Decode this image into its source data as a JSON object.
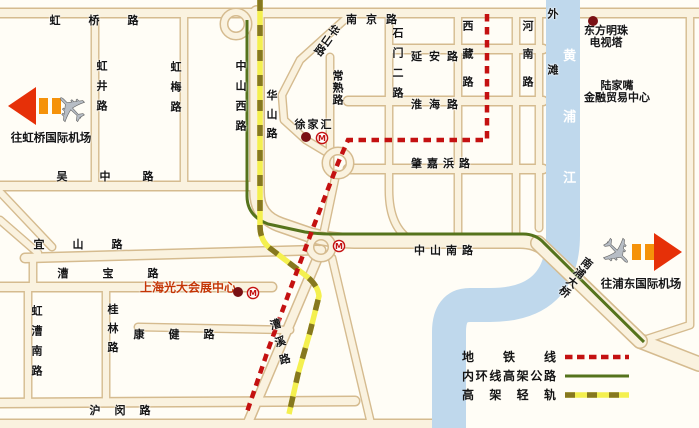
{
  "colors": {
    "metro_line": "#c41111",
    "inner_ring_line": "#55731c",
    "light_rail": "#f4f04f",
    "light_rail_dash": "#86781f",
    "river": "#bfd8ec",
    "road_fill": "#faf2df",
    "road_edge": "#d5bb8f",
    "label_text": "#151515",
    "red_label_text": "#c43605",
    "arrow_red": "#e63008",
    "arrow_orange": "#f5920a",
    "plane_gray": "#b7bdc5",
    "landmark_dot": "#7a1014",
    "river_label": "#ffffff"
  },
  "legend": {
    "items": [
      {
        "label": "地铁线",
        "type": "metro-line"
      },
      {
        "label": "内环线高架公路",
        "type": "inner-ring-elevated-road"
      },
      {
        "label": "高架轻轨",
        "type": "elevated-light-rail"
      }
    ]
  },
  "labels": [
    {
      "name": "road-label-hongqiao-rd",
      "text": "虹桥路",
      "x": 108,
      "y": 21,
      "v": 0,
      "sp": 28
    },
    {
      "name": "road-label-nanjing-rd",
      "text": "南京路",
      "x": 376,
      "y": 20,
      "v": 0,
      "sp": 9
    },
    {
      "name": "road-label-yanan-rd",
      "text": "延安路",
      "x": 438,
      "y": 57,
      "v": 0,
      "sp": 7
    },
    {
      "name": "road-label-huaihai-rd",
      "text": "淮海路",
      "x": 438,
      "y": 105,
      "v": 0,
      "sp": 7
    },
    {
      "name": "road-label-zhaojiabang-rd",
      "text": "肇嘉浜路",
      "x": 443,
      "y": 164,
      "v": 0,
      "sp": 5
    },
    {
      "name": "road-label-zhongshan-south-rd",
      "text": "中山南路",
      "x": 446,
      "y": 251,
      "v": 0,
      "sp": 5
    },
    {
      "name": "road-label-wuzhong-rd",
      "text": "吴中路",
      "x": 121,
      "y": 177,
      "v": 0,
      "sp": 32
    },
    {
      "name": "road-label-yishan-rd",
      "text": "宜山路",
      "x": 92,
      "y": 245,
      "v": 0,
      "sp": 28
    },
    {
      "name": "road-label-caobao-rd",
      "text": "漕宝路",
      "x": 125,
      "y": 274,
      "v": 0,
      "sp": 34
    },
    {
      "name": "road-label-kangjian-rd",
      "text": "康健路",
      "x": 186,
      "y": 335,
      "v": 0,
      "sp": 24
    },
    {
      "name": "road-label-humin-rd",
      "text": "沪闵路",
      "x": 127,
      "y": 411,
      "v": 0,
      "sp": 14
    },
    {
      "name": "road-label-hongjing-rd",
      "text": "虹井路",
      "x": 101,
      "y": 90,
      "v": 1,
      "sp": 9
    },
    {
      "name": "road-label-hongmei-rd",
      "text": "虹梅路",
      "x": 175,
      "y": 91,
      "v": 1,
      "sp": 9
    },
    {
      "name": "road-label-zhongshan-west-rd",
      "text": "中山西路",
      "x": 240,
      "y": 100,
      "v": 1,
      "sp": 9
    },
    {
      "name": "road-label-huashan-rd-south",
      "text": "华山路",
      "x": 271,
      "y": 118,
      "v": 1,
      "sp": 8
    },
    {
      "name": "road-label-changshu-rd",
      "text": "常熟路",
      "x": 337,
      "y": 88,
      "v": 1,
      "sp": 1
    },
    {
      "name": "road-label-shimen-er-rd",
      "text": "石门二路",
      "x": 397,
      "y": 67,
      "v": 1,
      "sp": 9
    },
    {
      "name": "road-label-xizang-rd",
      "text": "西藏路",
      "x": 467,
      "y": 62,
      "v": 1,
      "sp": 17
    },
    {
      "name": "road-label-henan-rd",
      "text": "河南路",
      "x": 527,
      "y": 62,
      "v": 1,
      "sp": 17
    },
    {
      "name": "road-label-the-bund",
      "text": "外滩",
      "x": 552,
      "y": 64,
      "v": 1,
      "sp": 45
    },
    {
      "name": "river-label-huangpu-river",
      "text": "黄浦江",
      "x": 567,
      "y": 140,
      "v": 1,
      "sp": 48,
      "cls": "river-text"
    },
    {
      "name": "road-label-hongcao-south-rd",
      "text": "虹漕南路",
      "x": 36,
      "y": 345,
      "v": 1,
      "sp": 9
    },
    {
      "name": "road-label-guilin-rd",
      "text": "桂林路",
      "x": 112,
      "y": 332,
      "v": 1,
      "sp": 8
    },
    {
      "name": "road-label-huashan-rd-north",
      "text": "华山路",
      "x": 326,
      "y": 40,
      "v": 1,
      "sp": 1,
      "rot": 35
    },
    {
      "name": "road-label-caoxi-rd",
      "text": "漕溪路",
      "x": 280,
      "y": 345,
      "v": 1,
      "sp": 7,
      "rot": -15
    },
    {
      "name": "bridge-label-nanpu-bridge",
      "text": "南浦大桥",
      "x": 575,
      "y": 277,
      "v": 1,
      "sp": 1,
      "rot": 38
    },
    {
      "name": "landmark-label-xujiahui",
      "text": "徐家汇",
      "x": 314,
      "y": 125,
      "v": 0,
      "sp": 2
    },
    {
      "name": "landmark-label-oriental-pearl-tower",
      "text": "东方明珠\n电视塔",
      "x": 606,
      "y": 37,
      "v": 0,
      "cls": "multiline"
    },
    {
      "name": "landmark-label-lujiazui",
      "text": "陆家嘴\n金融贸易中心",
      "x": 617,
      "y": 92,
      "v": 0,
      "cls": "multiline"
    },
    {
      "name": "landmark-label-everbright-center",
      "text": "上海光大会展中心",
      "x": 188,
      "y": 288,
      "v": 0,
      "cls": "red-label"
    },
    {
      "name": "label-to-hongqiao-airport",
      "text": "往虹桥国际机场",
      "x": 51,
      "y": 138,
      "v": 0,
      "cls": "airport"
    },
    {
      "name": "label-to-pudong-airport",
      "text": "往浦东国际机场",
      "x": 641,
      "y": 284,
      "v": 0,
      "cls": "airport"
    }
  ]
}
